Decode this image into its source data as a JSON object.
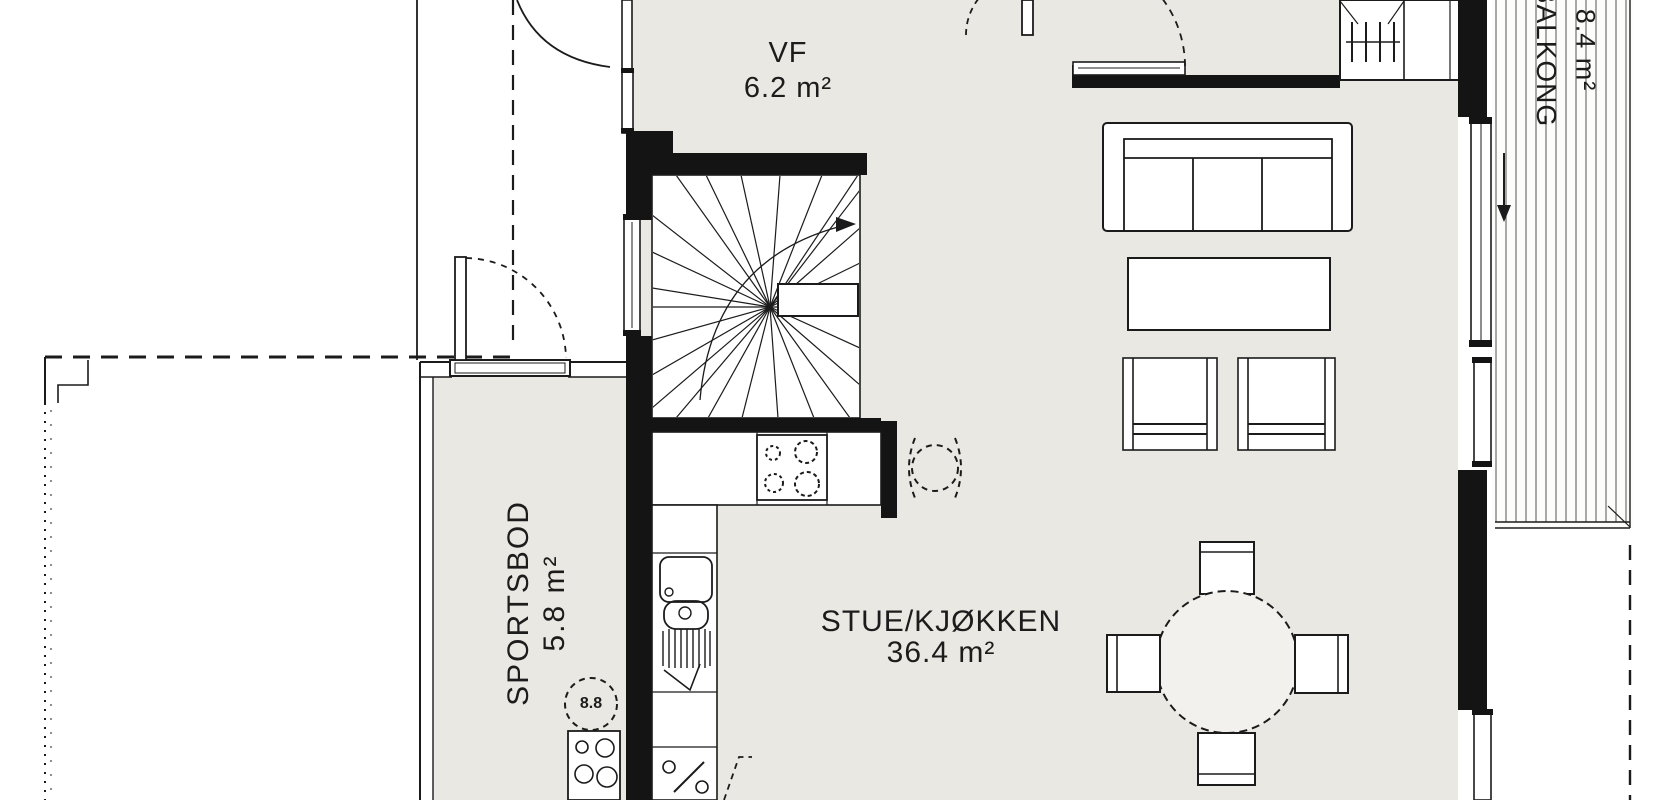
{
  "plan": {
    "title": "Floor plan - first floor",
    "rooms": [
      {
        "name": "VF",
        "area": "6.2 m²"
      },
      {
        "name": "STUE/KJØKKEN",
        "area": "36.4 m²"
      },
      {
        "name": "SPORTSBOD",
        "area": "5.8 m²"
      },
      {
        "name": "BALKONG",
        "area": "8.4 m²"
      }
    ],
    "annotations": {
      "water_heater": "8.8"
    },
    "fixtures": [
      "winder-staircase",
      "stove-4-burners",
      "kitchen-sink-with-drainboard",
      "dishwasher-provision",
      "washing-machine",
      "water-heater",
      "fireplace-chimney",
      "sofa-3-seat",
      "coffee-table",
      "armchair",
      "armchair",
      "round-dining-table",
      "dining-chair",
      "dining-chair",
      "dining-chair",
      "dining-chair",
      "balcony-decking",
      "sliding-door-arrow"
    ],
    "colors": {
      "wall": "#141414",
      "line": "#1b1b1b",
      "floor": "#eae8e2",
      "paper": "#ffffff",
      "deck_line": "#707070"
    }
  }
}
